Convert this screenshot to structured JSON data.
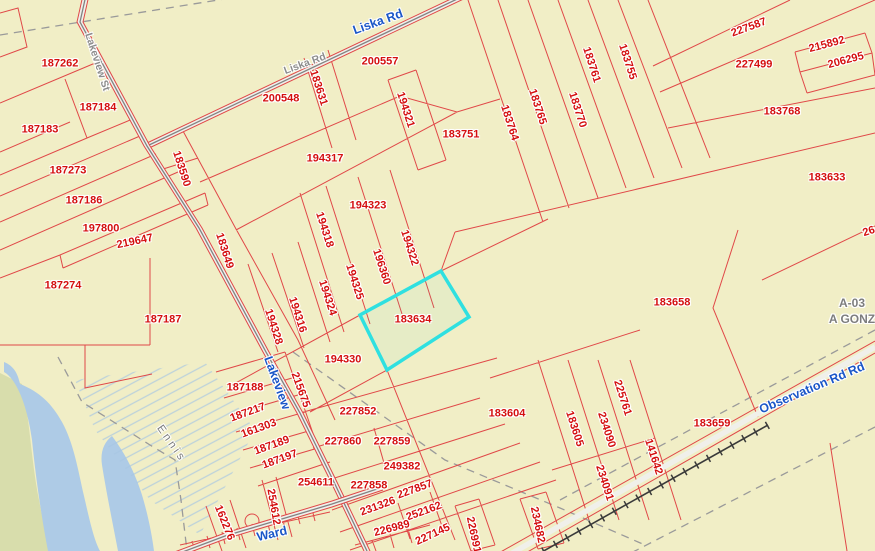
{
  "map": {
    "highlighted_parcel": "183634",
    "colors": {
      "background": "#f1eec6",
      "parcel_line": "#e04848",
      "parcel_label": "#d40f0f",
      "road_label_blue": "#1a56c8",
      "road_label_gray": "#8c8c8c",
      "area_label_gray": "#7d7d7d",
      "highlight": "#2fe0e0",
      "water": "#aecbe6",
      "wetland_hatch": "#a7c6e2",
      "land_green": "#d8ddac",
      "boundary_dash": "#9a9a9a",
      "railroad": "#3a3a3a",
      "road_fill": "#f0f0ea"
    },
    "parcel_labels": [
      {
        "t": "187262",
        "x": 60,
        "y": 64,
        "r": 0
      },
      {
        "t": "187184",
        "x": 98,
        "y": 108,
        "r": 0
      },
      {
        "t": "187183",
        "x": 40,
        "y": 130,
        "r": 0
      },
      {
        "t": "187273",
        "x": 68,
        "y": 171,
        "r": 0
      },
      {
        "t": "187186",
        "x": 84,
        "y": 201,
        "r": 0
      },
      {
        "t": "197800",
        "x": 101,
        "y": 229,
        "r": 0
      },
      {
        "t": "219647",
        "x": 135,
        "y": 242,
        "r": -12
      },
      {
        "t": "187274",
        "x": 63,
        "y": 286,
        "r": 0
      },
      {
        "t": "187187",
        "x": 163,
        "y": 320,
        "r": 0
      },
      {
        "t": "183590",
        "x": 181,
        "y": 169,
        "r": 72
      },
      {
        "t": "183649",
        "x": 224,
        "y": 251,
        "r": 72
      },
      {
        "t": "200548",
        "x": 281,
        "y": 99,
        "r": 0
      },
      {
        "t": "200557",
        "x": 380,
        "y": 62,
        "r": 0
      },
      {
        "t": "183631",
        "x": 318,
        "y": 88,
        "r": 72
      },
      {
        "t": "194321",
        "x": 405,
        "y": 110,
        "r": 72
      },
      {
        "t": "194317",
        "x": 325,
        "y": 159,
        "r": 0
      },
      {
        "t": "194323",
        "x": 368,
        "y": 206,
        "r": 0
      },
      {
        "t": "194318",
        "x": 324,
        "y": 230,
        "r": 72
      },
      {
        "t": "196360",
        "x": 381,
        "y": 267,
        "r": 72
      },
      {
        "t": "194322",
        "x": 409,
        "y": 248,
        "r": 72
      },
      {
        "t": "194325",
        "x": 354,
        "y": 282,
        "r": 72
      },
      {
        "t": "194324",
        "x": 327,
        "y": 298,
        "r": 72
      },
      {
        "t": "194316",
        "x": 297,
        "y": 315,
        "r": 72
      },
      {
        "t": "194328",
        "x": 273,
        "y": 327,
        "r": 72
      },
      {
        "t": "183634",
        "x": 413,
        "y": 320,
        "r": 0
      },
      {
        "t": "194330",
        "x": 343,
        "y": 360,
        "r": 0
      },
      {
        "t": "183751",
        "x": 461,
        "y": 135,
        "r": 0
      },
      {
        "t": "183764",
        "x": 509,
        "y": 123,
        "r": 72
      },
      {
        "t": "183765",
        "x": 537,
        "y": 107,
        "r": 72
      },
      {
        "t": "183770",
        "x": 577,
        "y": 110,
        "r": 72
      },
      {
        "t": "183761",
        "x": 591,
        "y": 65,
        "r": 72
      },
      {
        "t": "183755",
        "x": 627,
        "y": 62,
        "r": 72
      },
      {
        "t": "227587",
        "x": 749,
        "y": 28,
        "r": -20
      },
      {
        "t": "227499",
        "x": 754,
        "y": 65,
        "r": 0
      },
      {
        "t": "215892",
        "x": 827,
        "y": 45,
        "r": -15
      },
      {
        "t": "206295",
        "x": 846,
        "y": 61,
        "r": -15
      },
      {
        "t": "183768",
        "x": 782,
        "y": 112,
        "r": 0
      },
      {
        "t": "183633",
        "x": 827,
        "y": 178,
        "r": 0
      },
      {
        "t": "26",
        "x": 869,
        "y": 232,
        "r": -18
      },
      {
        "t": "183658",
        "x": 672,
        "y": 303,
        "r": 0
      },
      {
        "t": "183604",
        "x": 507,
        "y": 414,
        "r": 0
      },
      {
        "t": "183605",
        "x": 574,
        "y": 429,
        "r": 72
      },
      {
        "t": "225761",
        "x": 622,
        "y": 398,
        "r": 72
      },
      {
        "t": "234090",
        "x": 606,
        "y": 430,
        "r": 72
      },
      {
        "t": "234091",
        "x": 604,
        "y": 483,
        "r": 72
      },
      {
        "t": "141642",
        "x": 653,
        "y": 457,
        "r": 72
      },
      {
        "t": "183659",
        "x": 712,
        "y": 424,
        "r": 0
      },
      {
        "t": "187188",
        "x": 245,
        "y": 388,
        "r": 0
      },
      {
        "t": "187217",
        "x": 248,
        "y": 413,
        "r": -20
      },
      {
        "t": "161303",
        "x": 259,
        "y": 429,
        "r": -20
      },
      {
        "t": "187189",
        "x": 272,
        "y": 446,
        "r": -20
      },
      {
        "t": "187197",
        "x": 280,
        "y": 460,
        "r": -20
      },
      {
        "t": "215675",
        "x": 300,
        "y": 390,
        "r": 70
      },
      {
        "t": "227852",
        "x": 358,
        "y": 412,
        "r": 0
      },
      {
        "t": "227860",
        "x": 343,
        "y": 442,
        "r": 0
      },
      {
        "t": "227859",
        "x": 392,
        "y": 442,
        "r": 0
      },
      {
        "t": "249382",
        "x": 402,
        "y": 467,
        "r": 0
      },
      {
        "t": "227858",
        "x": 369,
        "y": 486,
        "r": 0
      },
      {
        "t": "227857",
        "x": 415,
        "y": 490,
        "r": -20
      },
      {
        "t": "231326",
        "x": 378,
        "y": 507,
        "r": -20
      },
      {
        "t": "252162",
        "x": 424,
        "y": 512,
        "r": -20
      },
      {
        "t": "226989",
        "x": 392,
        "y": 529,
        "r": -15
      },
      {
        "t": "227145",
        "x": 433,
        "y": 535,
        "r": -25
      },
      {
        "t": "226991",
        "x": 473,
        "y": 535,
        "r": 78
      },
      {
        "t": "234682",
        "x": 537,
        "y": 525,
        "r": 78
      },
      {
        "t": "254611",
        "x": 316,
        "y": 483,
        "r": 0
      },
      {
        "t": "254612",
        "x": 273,
        "y": 507,
        "r": 80
      },
      {
        "t": "162276",
        "x": 224,
        "y": 523,
        "r": 68
      }
    ],
    "road_labels_blue": [
      {
        "t": "Liska Rd",
        "x": 378,
        "y": 22,
        "r": -20
      },
      {
        "t": "Lakeview",
        "x": 277,
        "y": 383,
        "r": 70
      },
      {
        "t": "Ward",
        "x": 272,
        "y": 534,
        "r": -13
      },
      {
        "t": "Observation Rd Rd",
        "x": 812,
        "y": 388,
        "r": -23
      }
    ],
    "road_labels_gray": [
      {
        "t": "Lakeview St",
        "x": 97,
        "y": 62,
        "r": 72
      },
      {
        "t": "Liska Rd",
        "x": 305,
        "y": 64,
        "r": -20
      }
    ],
    "area_labels": [
      {
        "t": "Ennis",
        "x": 171,
        "y": 444,
        "r": 55,
        "thin": true,
        "ls": 3
      },
      {
        "t": "A-03",
        "x": 852,
        "y": 303,
        "r": 0
      },
      {
        "t": "A GONZ",
        "x": 852,
        "y": 319,
        "r": 0
      }
    ]
  }
}
